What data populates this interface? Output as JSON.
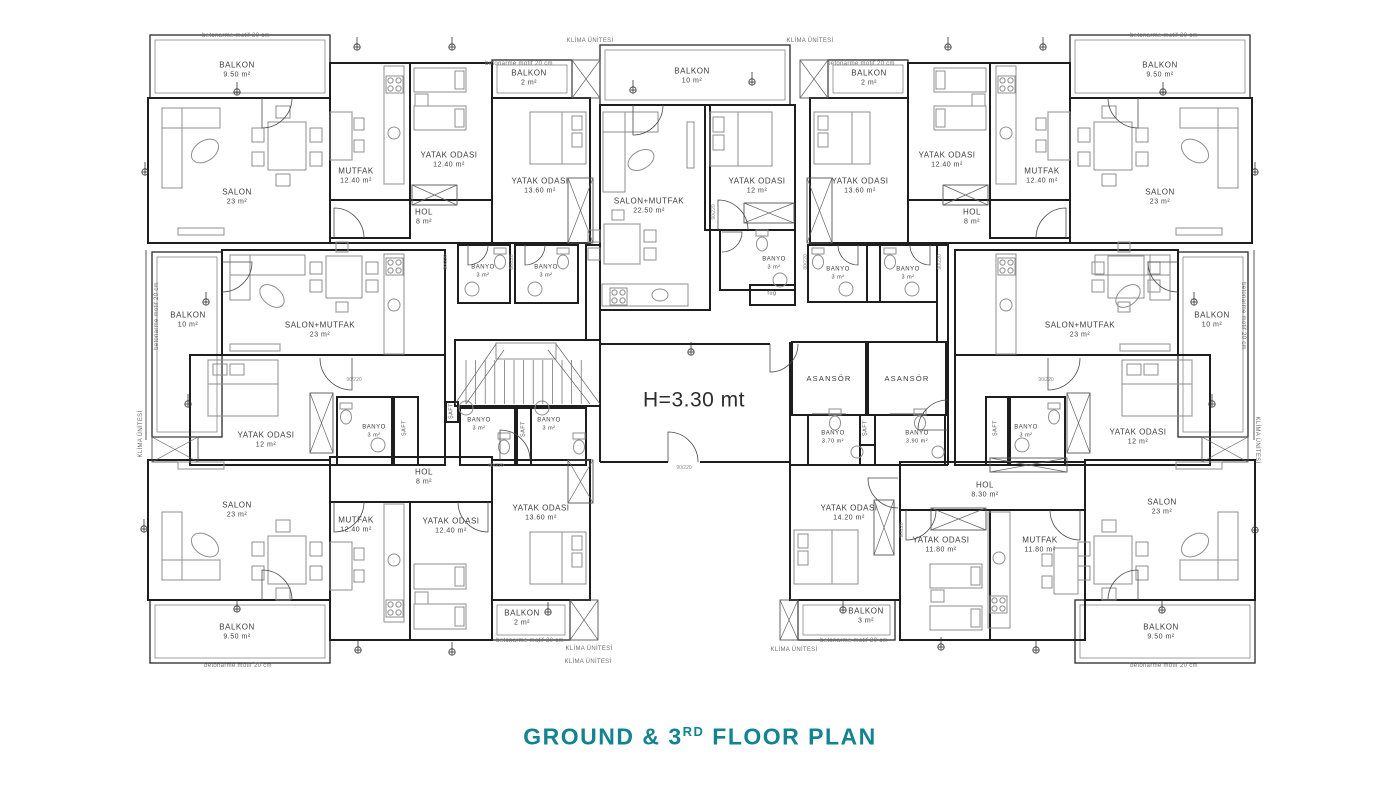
{
  "title": {
    "line": "GROUND & 3",
    "sup": "RD",
    "rest": " FLOOR PLAN",
    "color": "#128490"
  },
  "plan": {
    "hall_height_note": "H=3.30 mt",
    "rooms": [
      {
        "id": "balkon-top-left",
        "name": "BALKON",
        "area": "9.50 m²",
        "x": 237,
        "y": 70
      },
      {
        "id": "salon-top-left",
        "name": "SALON",
        "area": "23 m²",
        "x": 237,
        "y": 197
      },
      {
        "id": "mutfak-top-left",
        "name": "MUTFAK",
        "area": "12.40 m²",
        "x": 356,
        "y": 176
      },
      {
        "id": "yatak-odasi-top-left",
        "name": "YATAK ODASI",
        "area": "12.40 m²",
        "x": 449,
        "y": 160
      },
      {
        "id": "hol-top-left",
        "name": "HOL",
        "area": "8 m²",
        "x": 424,
        "y": 217
      },
      {
        "id": "balkon2-top-left",
        "name": "BALKON",
        "area": "2 m²",
        "x": 529,
        "y": 78
      },
      {
        "id": "yatak-odasi-1360-top-left",
        "name": "YATAK ODASI",
        "area": "13.60 m²",
        "x": 540,
        "y": 186
      },
      {
        "id": "balkon-top-center",
        "name": "BALKON",
        "area": "10 m²",
        "x": 692,
        "y": 76
      },
      {
        "id": "salon-mutfak-top-center",
        "name": "SALON+MUTFAK",
        "area": "22.50 m²",
        "x": 649,
        "y": 206
      },
      {
        "id": "yatak-odasi-top-center",
        "name": "YATAK ODASI",
        "area": "12 m²",
        "x": 757,
        "y": 186
      },
      {
        "id": "banyo-top-center",
        "name": "BANYO",
        "area": "3 m²",
        "x": 774,
        "y": 264,
        "cls": "sm"
      },
      {
        "id": "fug-room",
        "name": "füg",
        "area": "",
        "x": 772,
        "y": 294,
        "cls": "micro2"
      },
      {
        "id": "banyo-a",
        "name": "BANYO",
        "area": "3 m²",
        "x": 483,
        "y": 272,
        "cls": "sm"
      },
      {
        "id": "banyo-b",
        "name": "BANYO",
        "area": "3 m²",
        "x": 546,
        "y": 272,
        "cls": "sm"
      },
      {
        "id": "banyo-c",
        "name": "BANYO",
        "area": "3 m²",
        "x": 838,
        "y": 274,
        "cls": "sm"
      },
      {
        "id": "banyo-d",
        "name": "BANYO",
        "area": "3 m²",
        "x": 908,
        "y": 274,
        "cls": "sm"
      },
      {
        "id": "balkon2-top-right",
        "name": "BALKON",
        "area": "2 m²",
        "x": 869,
        "y": 78
      },
      {
        "id": "yatak-odasi-1360-top-right",
        "name": "YATAK ODASI",
        "area": "13.60 m²",
        "x": 860,
        "y": 186
      },
      {
        "id": "yatak-odasi-top-right",
        "name": "YATAK ODASI",
        "area": "12.40 m²",
        "x": 947,
        "y": 160
      },
      {
        "id": "mutfak-top-right",
        "name": "MUTFAK",
        "area": "12.40 m²",
        "x": 1042,
        "y": 176
      },
      {
        "id": "hol-top-right",
        "name": "HOL",
        "area": "8 m²",
        "x": 972,
        "y": 217
      },
      {
        "id": "salon-top-right",
        "name": "SALON",
        "area": "23 m²",
        "x": 1160,
        "y": 197
      },
      {
        "id": "balkon-top-right",
        "name": "BALKON",
        "area": "9.50 m²",
        "x": 1160,
        "y": 70
      },
      {
        "id": "balkon-mid-left",
        "name": "BALKON",
        "area": "10 m²",
        "x": 188,
        "y": 320
      },
      {
        "id": "salon-mutfak-mid-left",
        "name": "SALON+MUTFAK",
        "area": "23 m²",
        "x": 320,
        "y": 330
      },
      {
        "id": "yatak-odasi-mid-left",
        "name": "YATAK ODASI",
        "area": "12 m²",
        "x": 266,
        "y": 440
      },
      {
        "id": "banyo-mid-left",
        "name": "BANYO",
        "area": "3 m²",
        "x": 374,
        "y": 432,
        "cls": "sm"
      },
      {
        "id": "saft-mid-left",
        "name": "ŞAFT",
        "area": "",
        "x": 405,
        "y": 428,
        "rot": -90,
        "cls": "micro2"
      },
      {
        "id": "saft-stair-left",
        "name": "ŞAFT",
        "area": "",
        "x": 452,
        "y": 411,
        "rot": -90,
        "cls": "micro2"
      },
      {
        "id": "banyo-stair-left",
        "name": "BANYO",
        "area": "3 m²",
        "x": 479,
        "y": 425,
        "cls": "sm"
      },
      {
        "id": "saft-stair-center",
        "name": "ŞAFT",
        "area": "",
        "x": 524,
        "y": 429,
        "rot": -90,
        "cls": "micro2"
      },
      {
        "id": "banyo-stair-right",
        "name": "BANYO",
        "area": "3 m²",
        "x": 549,
        "y": 425,
        "cls": "sm"
      },
      {
        "id": "hall-height",
        "name": "H=3.30 mt",
        "area": "",
        "x": 694,
        "y": 400,
        "cls": "big"
      },
      {
        "id": "asansor-1",
        "name": "ASANSÖR",
        "area": "",
        "x": 829,
        "y": 379,
        "cls": "as"
      },
      {
        "id": "asansor-2",
        "name": "ASANSÖR",
        "area": "",
        "x": 907,
        "y": 379,
        "cls": "as"
      },
      {
        "id": "banyo-elevator-1",
        "name": "BANYO",
        "area": "3.70 m²",
        "x": 833,
        "y": 438,
        "cls": "sm"
      },
      {
        "id": "saft-elevator",
        "name": "ŞAFT",
        "area": "",
        "x": 866,
        "y": 428,
        "rot": -90,
        "cls": "micro2"
      },
      {
        "id": "banyo-elevator-2",
        "name": "BANYO",
        "area": "3.90 m²",
        "x": 917,
        "y": 438,
        "cls": "sm"
      },
      {
        "id": "saft-mid-right",
        "name": "ŞAFT",
        "area": "",
        "x": 996,
        "y": 428,
        "rot": -90,
        "cls": "micro2"
      },
      {
        "id": "banyo-mid-right",
        "name": "BANYO",
        "area": "3 m²",
        "x": 1026,
        "y": 432,
        "cls": "sm"
      },
      {
        "id": "salon-mutfak-mid-right",
        "name": "SALON+MUTFAK",
        "area": "23 m²",
        "x": 1080,
        "y": 330
      },
      {
        "id": "balkon-mid-right",
        "name": "BALKON",
        "area": "10 m²",
        "x": 1212,
        "y": 320
      },
      {
        "id": "yatak-odasi-mid-right",
        "name": "YATAK ODASI",
        "area": "12 m²",
        "x": 1138,
        "y": 437
      },
      {
        "id": "salon-bottom-left",
        "name": "SALON",
        "area": "23 m²",
        "x": 237,
        "y": 510
      },
      {
        "id": "mutfak-bottom-left",
        "name": "MUTFAK",
        "area": "12.40 m²",
        "x": 356,
        "y": 525
      },
      {
        "id": "yatak-odasi-bottom-left",
        "name": "YATAK ODASI",
        "area": "12.40 m²",
        "x": 451,
        "y": 526
      },
      {
        "id": "hol-bottom-left",
        "name": "HOL",
        "area": "8 m²",
        "x": 424,
        "y": 477
      },
      {
        "id": "yatak-odasi-1360-bottom-left",
        "name": "YATAK ODASI",
        "area": "13.60 m²",
        "x": 541,
        "y": 513
      },
      {
        "id": "balkon2-bottom-left",
        "name": "BALKON",
        "area": "2 m²",
        "x": 522,
        "y": 618
      },
      {
        "id": "balkon-bottom-left",
        "name": "BALKON",
        "area": "9.50 m²",
        "x": 237,
        "y": 632
      },
      {
        "id": "hol-bottom-right",
        "name": "HOL",
        "area": "8.30 m²",
        "x": 985,
        "y": 490
      },
      {
        "id": "yatak-odasi-1420-bottom-right",
        "name": "YATAK ODASI",
        "area": "14.20 m²",
        "x": 849,
        "y": 513
      },
      {
        "id": "yatak-odasi-1180-bottom-right",
        "name": "YATAK ODASI",
        "area": "11.80 m²",
        "x": 941,
        "y": 545
      },
      {
        "id": "mutfak-bottom-right",
        "name": "MUTFAK",
        "area": "11.80 m²",
        "x": 1040,
        "y": 545
      },
      {
        "id": "balkon3-bottom-right",
        "name": "BALKON",
        "area": "3 m²",
        "x": 866,
        "y": 616
      },
      {
        "id": "salon-bottom-right",
        "name": "SALON",
        "area": "23 m²",
        "x": 1162,
        "y": 507
      },
      {
        "id": "balkon-bottom-right",
        "name": "BALKON",
        "area": "9.50 m²",
        "x": 1161,
        "y": 632
      }
    ],
    "annotations": [
      {
        "id": "betonarme-1",
        "text": "betonarme motif 20 cm",
        "x": 236,
        "y": 36
      },
      {
        "id": "betonarme-2",
        "text": "betonarme motif 20 cm",
        "x": 519,
        "y": 64
      },
      {
        "id": "betonarme-3",
        "text": "betonarme motif 20 cm",
        "x": 861,
        "y": 64
      },
      {
        "id": "betonarme-4",
        "text": "betonarme motif 20 cm",
        "x": 1164,
        "y": 36
      },
      {
        "id": "betonarme-5",
        "text": "betonarme motif 20 cm",
        "x": 157,
        "y": 316,
        "rot": -90
      },
      {
        "id": "betonarme-6",
        "text": "betonarme motif 20 cm",
        "x": 1243,
        "y": 316,
        "rot": 90
      },
      {
        "id": "betonarme-7",
        "text": "betonarme motif 20 cm",
        "x": 238,
        "y": 666
      },
      {
        "id": "betonarme-8",
        "text": "betonarme motif 20 cm",
        "x": 530,
        "y": 641
      },
      {
        "id": "betonarme-9",
        "text": "betonarme motif 20 cm",
        "x": 854,
        "y": 641
      },
      {
        "id": "betonarme-10",
        "text": "betonarme motif 20 cm",
        "x": 1164,
        "y": 666
      },
      {
        "id": "klima-1",
        "text": "KLİMA ÜNİTESİ",
        "x": 590,
        "y": 41
      },
      {
        "id": "klima-2",
        "text": "KLİMA ÜNİTESİ",
        "x": 810,
        "y": 41
      },
      {
        "id": "klima-3",
        "text": "KLİMA ÜNİTESİ",
        "x": 141,
        "y": 434,
        "rot": -90
      },
      {
        "id": "klima-4",
        "text": "KLİMA ÜNİTESİ",
        "x": 1257,
        "y": 440,
        "rot": 90
      },
      {
        "id": "klima-5",
        "text": "KLİMA ÜNİTESİ",
        "x": 589,
        "y": 649
      },
      {
        "id": "klima-6",
        "text": "KLİMA ÜNİTESİ",
        "x": 588,
        "y": 662
      },
      {
        "id": "klima-7",
        "text": "KLİMA ÜNİTESİ",
        "x": 794,
        "y": 650
      }
    ],
    "door_tags": [
      {
        "text": "90/220",
        "x": 446,
        "y": 262,
        "rot": -90
      },
      {
        "text": "80/220",
        "x": 512,
        "y": 262,
        "rot": -90
      },
      {
        "text": "80/220",
        "x": 806,
        "y": 262,
        "rot": -90
      },
      {
        "text": "90/220",
        "x": 940,
        "y": 262,
        "rot": -90
      },
      {
        "text": "90/220",
        "x": 714,
        "y": 212,
        "rot": -90
      },
      {
        "text": "90/220",
        "x": 354,
        "y": 380
      },
      {
        "text": "90/220",
        "x": 1046,
        "y": 380
      },
      {
        "text": "90/220",
        "x": 684,
        "y": 468
      },
      {
        "text": "80/220",
        "x": 496,
        "y": 466
      },
      {
        "text": "90/220",
        "x": 902,
        "y": 530,
        "rot": -90
      }
    ]
  }
}
